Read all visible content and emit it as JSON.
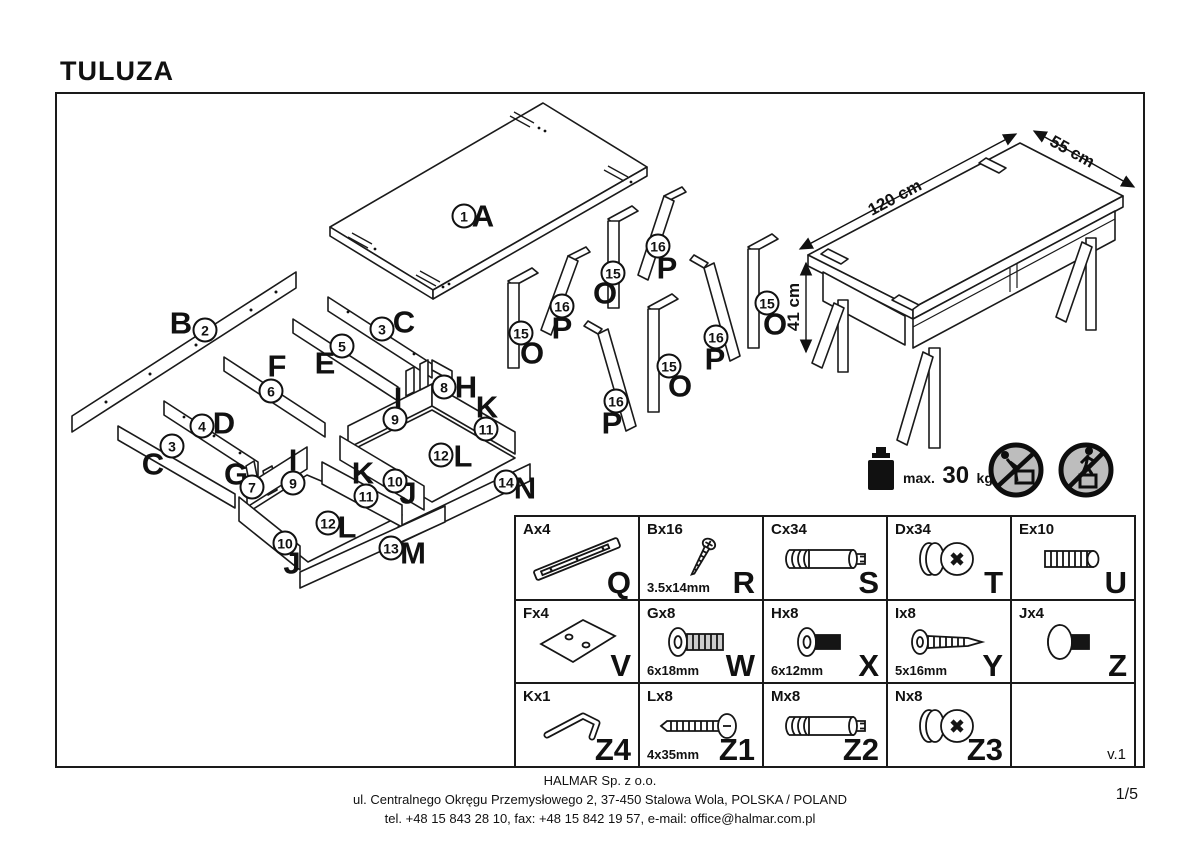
{
  "title": "TULUZA",
  "version": "v.1",
  "page_number": "1/5",
  "company": {
    "name": "HALMAR Sp. z o.o.",
    "address": "ul. Centralnego Okręgu Przemysłowego 2, 37-450 Stalowa Wola, POLSKA / POLAND",
    "contact": "tel. +48 15 843 28 10, fax: +48 15 842 19 57, e-mail: office@halmar.com.pl"
  },
  "dimensions": {
    "length": "120 cm",
    "depth": "55 cm",
    "height": "41 cm"
  },
  "load_limit": {
    "label": "max.",
    "value": "30",
    "unit": "kg"
  },
  "safety_icons": [
    {
      "name": "no-pushing"
    },
    {
      "name": "no-standing"
    }
  ],
  "exploded_labels": [
    {
      "letter": "A",
      "number": "1",
      "lx": 483,
      "ly": 216,
      "nx": 464,
      "ny": 216
    },
    {
      "letter": "B",
      "number": "2",
      "lx": 181,
      "ly": 323,
      "nx": 205,
      "ny": 330
    },
    {
      "letter": "C",
      "number": "3",
      "lx": 404,
      "ly": 322,
      "nx": 382,
      "ny": 329
    },
    {
      "letter": "E",
      "number": "5",
      "lx": 325,
      "ly": 363,
      "nx": 342,
      "ny": 346
    },
    {
      "letter": "F",
      "number": "6",
      "lx": 277,
      "ly": 366,
      "nx": 271,
      "ny": 391
    },
    {
      "letter": "D",
      "number": "4",
      "lx": 224,
      "ly": 423,
      "nx": 202,
      "ny": 426
    },
    {
      "letter": "C",
      "number": "3",
      "lx": 153,
      "ly": 464,
      "nx": 172,
      "ny": 446
    },
    {
      "letter": "G",
      "number": "7",
      "lx": 236,
      "ly": 474,
      "nx": 252,
      "ny": 487
    },
    {
      "letter": "H",
      "number": "8",
      "lx": 466,
      "ly": 387,
      "nx": 444,
      "ny": 387
    },
    {
      "letter": "I",
      "number": "9",
      "lx": 398,
      "ly": 398,
      "nx": 395,
      "ny": 419
    },
    {
      "letter": "K",
      "number": "11",
      "lx": 487,
      "ly": 407,
      "nx": 486,
      "ny": 429
    },
    {
      "letter": "L",
      "number": "12",
      "lx": 463,
      "ly": 456,
      "nx": 441,
      "ny": 455
    },
    {
      "letter": "J",
      "number": "10",
      "lx": 408,
      "ly": 493,
      "nx": 395,
      "ny": 481
    },
    {
      "letter": "N",
      "number": "14",
      "lx": 525,
      "ly": 488,
      "nx": 506,
      "ny": 482
    },
    {
      "letter": "I",
      "number": "9",
      "lx": 293,
      "ly": 460,
      "nx": 293,
      "ny": 483
    },
    {
      "letter": "K",
      "number": "11",
      "lx": 363,
      "ly": 473,
      "nx": 366,
      "ny": 496
    },
    {
      "letter": "L",
      "number": "12",
      "lx": 347,
      "ly": 527,
      "nx": 328,
      "ny": 523
    },
    {
      "letter": "J",
      "number": "10",
      "lx": 292,
      "ly": 563,
      "nx": 285,
      "ny": 543
    },
    {
      "letter": "M",
      "number": "13",
      "lx": 413,
      "ly": 553,
      "nx": 391,
      "ny": 548
    },
    {
      "letter": "O",
      "number": "15",
      "lx": 532,
      "ly": 353,
      "nx": 521,
      "ny": 333
    },
    {
      "letter": "P",
      "number": "16",
      "lx": 562,
      "ly": 328,
      "nx": 562,
      "ny": 306
    },
    {
      "letter": "O",
      "number": "15",
      "lx": 605,
      "ly": 293,
      "nx": 613,
      "ny": 273
    },
    {
      "letter": "P",
      "number": "16",
      "lx": 667,
      "ly": 268,
      "nx": 658,
      "ny": 246
    },
    {
      "letter": "O",
      "number": "15",
      "lx": 680,
      "ly": 386,
      "nx": 669,
      "ny": 366
    },
    {
      "letter": "P",
      "number": "16",
      "lx": 612,
      "ly": 423,
      "nx": 616,
      "ny": 401
    },
    {
      "letter": "O",
      "number": "15",
      "lx": 775,
      "ly": 324,
      "nx": 767,
      "ny": 303
    },
    {
      "letter": "P",
      "number": "16",
      "lx": 715,
      "ly": 359,
      "nx": 716,
      "ny": 337
    }
  ],
  "parts_table": {
    "cells": [
      {
        "code": "Ax4",
        "size": "",
        "ref": "Q",
        "icon": "drawer-slide",
        "note": ""
      },
      {
        "code": "Bx16",
        "size": "3.5x14mm",
        "ref": "R",
        "icon": "screw-small",
        "note": ""
      },
      {
        "code": "Cx34",
        "size": "",
        "ref": "S",
        "icon": "bolt-pin",
        "note": ""
      },
      {
        "code": "Dx34",
        "size": "",
        "ref": "T",
        "icon": "cam-lock",
        "note": ""
      },
      {
        "code": "Ex10",
        "size": "",
        "ref": "U",
        "icon": "wood-dowel",
        "note": ""
      },
      {
        "code": "Fx4",
        "size": "",
        "ref": "V",
        "icon": "plate",
        "note": ""
      },
      {
        "code": "Gx8",
        "size": "6x18mm",
        "ref": "W",
        "icon": "flange-bolt",
        "note": ""
      },
      {
        "code": "Hx8",
        "size": "6x12mm",
        "ref": "X",
        "icon": "short-bolt",
        "note": ""
      },
      {
        "code": "Ix8",
        "size": "5x16mm",
        "ref": "Y",
        "icon": "wood-screw",
        "note": ""
      },
      {
        "code": "Jx4",
        "size": "",
        "ref": "Z",
        "icon": "thumb-bolt",
        "note": ""
      },
      {
        "code": "Kx1",
        "size": "",
        "ref": "Z4",
        "icon": "allen-key",
        "note": ""
      },
      {
        "code": "Lx8",
        "size": "4x35mm",
        "ref": "Z1",
        "icon": "long-screw",
        "note": ""
      },
      {
        "code": "Mx8",
        "size": "",
        "ref": "Z2",
        "icon": "bolt-pin",
        "note": ""
      },
      {
        "code": "Nx8",
        "size": "",
        "ref": "Z3",
        "icon": "cam-lock",
        "note": ""
      },
      {
        "code": "",
        "size": "",
        "ref": "",
        "icon": "none",
        "note": "v.1"
      }
    ]
  }
}
